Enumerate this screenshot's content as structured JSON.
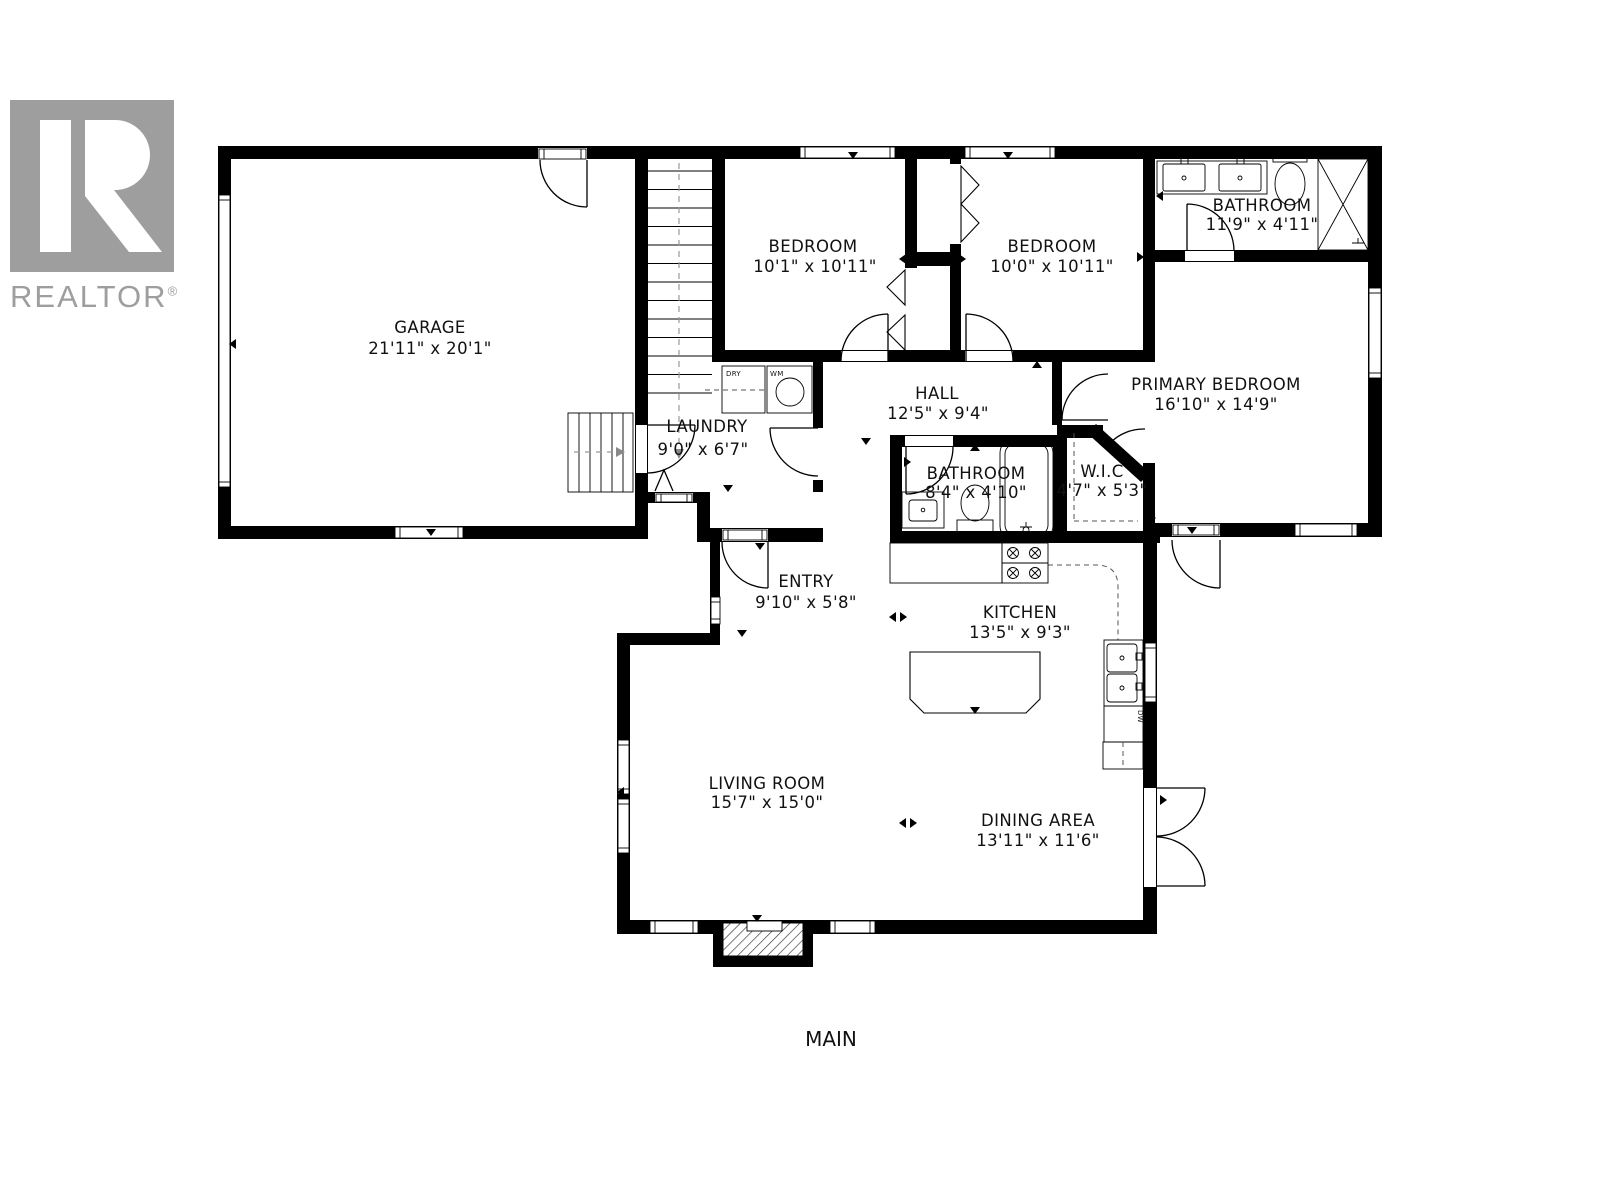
{
  "logo": {
    "brand": "REALTOR",
    "registered": "®",
    "monogram": "R"
  },
  "floor_label": "MAIN",
  "colors": {
    "wall": "#000000",
    "logo_gray": "#9e9e9e",
    "background": "#ffffff"
  },
  "rooms": [
    {
      "id": "garage",
      "name": "GARAGE",
      "dims": "21'11\" x 20'1\""
    },
    {
      "id": "bedroom-1",
      "name": "BEDROOM",
      "dims": "10'1\" x 10'11\""
    },
    {
      "id": "bedroom-2",
      "name": "BEDROOM",
      "dims": "10'0\" x 10'11\""
    },
    {
      "id": "bathroom-ensuite",
      "name": "BATHROOM",
      "dims": "11'9\" x 4'11\""
    },
    {
      "id": "primary-bedroom",
      "name": "PRIMARY BEDROOM",
      "dims": "16'10\" x 14'9\""
    },
    {
      "id": "hall",
      "name": "HALL",
      "dims": "12'5\" x 9'4\""
    },
    {
      "id": "laundry",
      "name": "LAUNDRY",
      "dims": "9'0\" x 6'7\""
    },
    {
      "id": "bathroom-main",
      "name": "BATHROOM",
      "dims": "8'4\" x 4'10\""
    },
    {
      "id": "wic",
      "name": "W.I.C",
      "dims": "4'7\" x 5'3\""
    },
    {
      "id": "entry",
      "name": "ENTRY",
      "dims": "9'10\" x 5'8\""
    },
    {
      "id": "kitchen",
      "name": "KITCHEN",
      "dims": "13'5\" x 9'3\""
    },
    {
      "id": "living-room",
      "name": "LIVING ROOM",
      "dims": "15'7\" x 15'0\""
    },
    {
      "id": "dining-area",
      "name": "DINING AREA",
      "dims": "13'11\" x 11'6\""
    }
  ],
  "appliances": {
    "dryer": "DRY",
    "washer": "WM",
    "dishwasher": "DW"
  }
}
